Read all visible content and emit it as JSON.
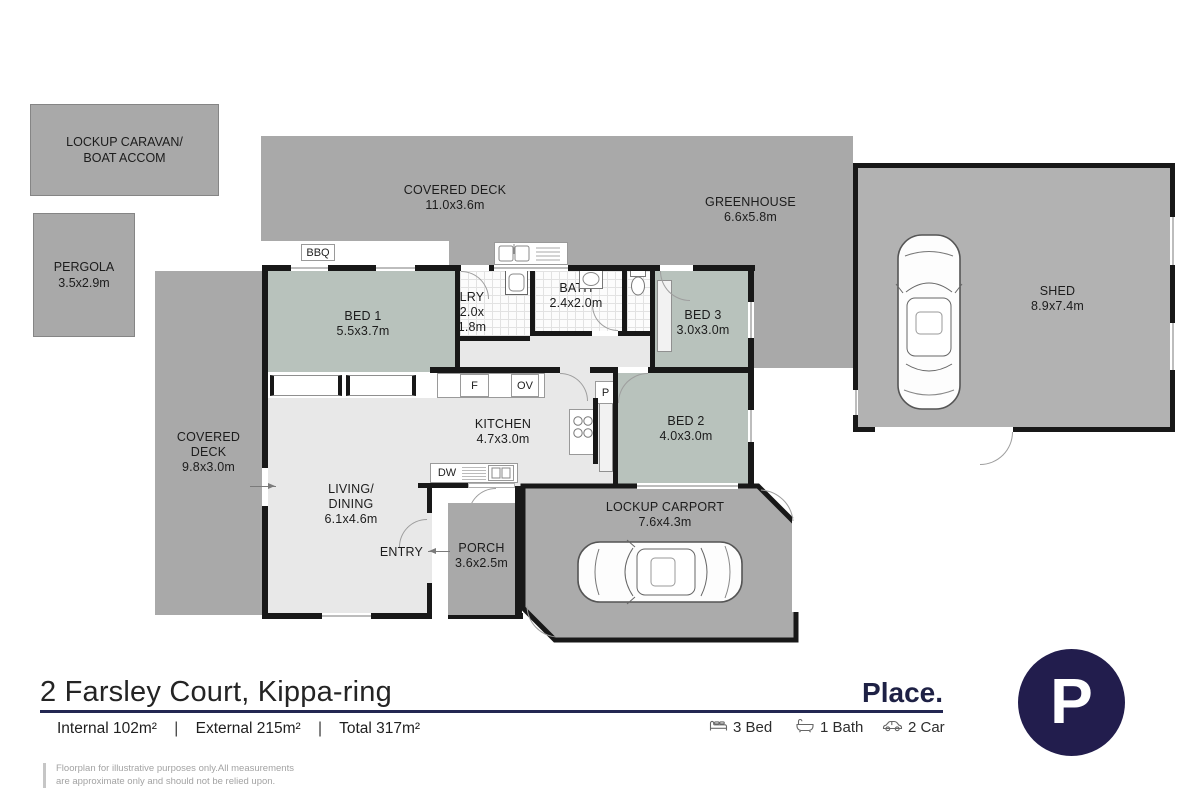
{
  "plan": {
    "outbuildings": {
      "caravan": {
        "name": "LOCKUP CARAVAN/ BOAT ACCOM"
      },
      "pergola": {
        "name": "PERGOLA",
        "dims": "3.5x2.9m"
      },
      "deck_top": {
        "name": "COVERED DECK",
        "dims": "11.0x3.6m"
      },
      "greenhouse": {
        "name": "GREENHOUSE",
        "dims": "6.6x5.8m"
      },
      "shed": {
        "name": "SHED",
        "dims": "8.9x7.4m"
      },
      "deck_left": {
        "name": "COVERED DECK",
        "dims": "9.8x3.0m"
      },
      "carport": {
        "name": "LOCKUP CARPORT",
        "dims": "7.6x4.3m"
      },
      "porch": {
        "name": "PORCH",
        "dims": "3.6x2.5m"
      }
    },
    "rooms": {
      "bed1": {
        "name": "BED 1",
        "dims": "5.5x3.7m"
      },
      "bed2": {
        "name": "BED 2",
        "dims": "4.0x3.0m"
      },
      "bed3": {
        "name": "BED 3",
        "dims": "3.0x3.0m"
      },
      "bath": {
        "name": "BATH",
        "dims": "2.4x2.0m"
      },
      "laundry": {
        "name": "LRY",
        "dims": "2.0x 1.8m"
      },
      "kitchen": {
        "name": "KITCHEN",
        "dims": "4.7x3.0m"
      },
      "living": {
        "name": "LIVING/ DINING",
        "dims": "6.1x4.6m"
      }
    },
    "fixtures": {
      "bbq": "BBQ",
      "fridge": "F",
      "oven": "OV",
      "pantry": "P",
      "dishwasher": "DW",
      "entry": "ENTRY"
    }
  },
  "footer": {
    "address": "2 Farsley Court, Kippa-ring",
    "areas": {
      "internal": "Internal 102m²",
      "external": "External 215m²",
      "total": "Total 317m²",
      "separator": "|"
    },
    "features": [
      {
        "icon": "bed-icon",
        "label": "3 Bed"
      },
      {
        "icon": "bath-icon",
        "label": "1 Bath"
      },
      {
        "icon": "car-icon",
        "label": "2 Car"
      }
    ],
    "brand": "Place.",
    "logo_letter": "P",
    "disclaimer_lines": [
      "Floorplan for illustrative purposes only.All measurements",
      "are approximate only and should not be relied upon."
    ]
  }
}
